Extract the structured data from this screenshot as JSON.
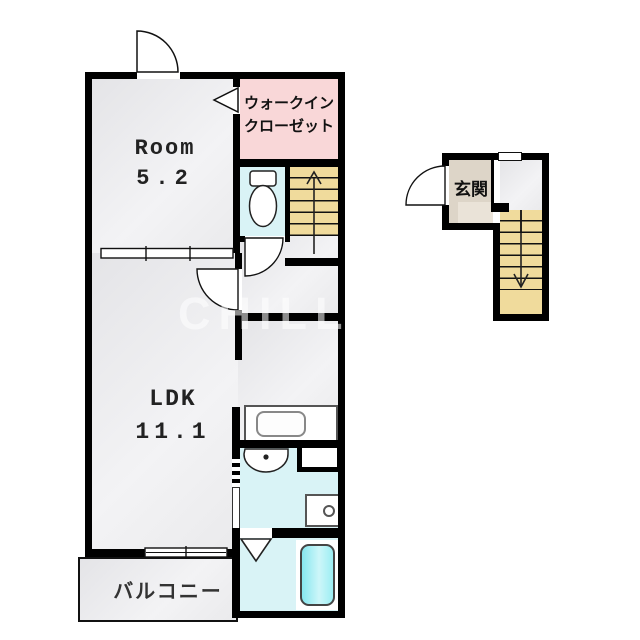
{
  "labels": {
    "room_name": "Room",
    "room_area": "5.2",
    "ldk_name": "LDK",
    "ldk_area": "11.1",
    "closet_line1": "ウォークイン",
    "closet_line2": "クローゼット",
    "entrance": "玄関",
    "balcony": "バルコニー",
    "watermark": "CHILL HOME"
  },
  "colors": {
    "wall": "#000000",
    "floor_gray": "#ebebed",
    "closet_pink": "#f9d7d8",
    "wet_area_cyan": "#d9f3f6",
    "stairs_tan": "#f0db9c",
    "entrance_beige": "#ddd5c8",
    "bathtub_cyan": "#8fe8ef"
  }
}
